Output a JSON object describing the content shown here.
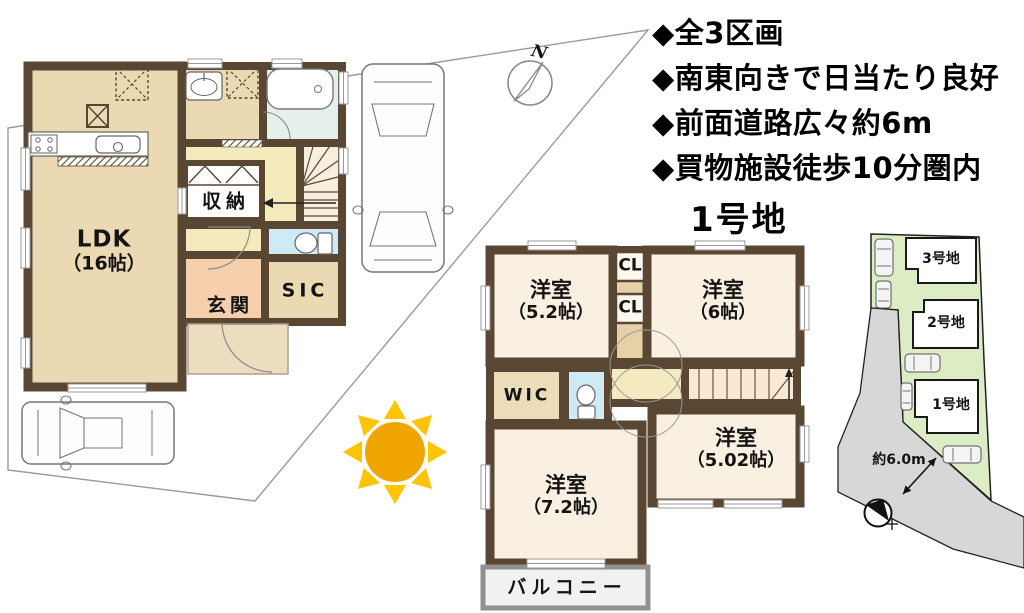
{
  "features": {
    "items": [
      {
        "label": "◆全3区画"
      },
      {
        "label": "◆南東向きで日当たり良好"
      },
      {
        "label": "◆前面道路広々約6m"
      },
      {
        "label": "◆買物施設徒歩10分圏内"
      }
    ]
  },
  "lot_title": "1号地",
  "floor1": {
    "ldk_name": "LDK",
    "ldk_size": "（16帖）",
    "storage": "収納",
    "entrance": "玄関",
    "shoe_closet": "SIC"
  },
  "floor2": {
    "room_a_name": "洋室",
    "room_a_size": "（5.2帖）",
    "room_b_name": "洋室",
    "room_b_size": "（6帖）",
    "room_c_name": "洋室",
    "room_c_size": "（7.2帖）",
    "room_d_name": "洋室",
    "room_d_size": "（5.02帖）",
    "closet1": "CL",
    "closet2": "CL",
    "wic": "WIC",
    "balcony": "バルコニー"
  },
  "site_plan": {
    "lot3": "3号地",
    "lot2": "2号地",
    "lot1": "1号地",
    "road_width": "約6.0m"
  },
  "compass": {
    "north_label": "N"
  },
  "colors": {
    "wall": "#5a4733",
    "floor_tan": "#ebd9b4",
    "room_cream": "#faf0e1",
    "hall_yellow": "#f4ebbc",
    "entrance_salmon": "#f6cfad",
    "bath_green": "#e4f0e9",
    "toilet_blue": "#cdeaf5",
    "site_green": "#dcedc6",
    "road_gray": "#d7d7d7",
    "sun_core": "#f0a500",
    "sun_ray": "#ffc400"
  }
}
